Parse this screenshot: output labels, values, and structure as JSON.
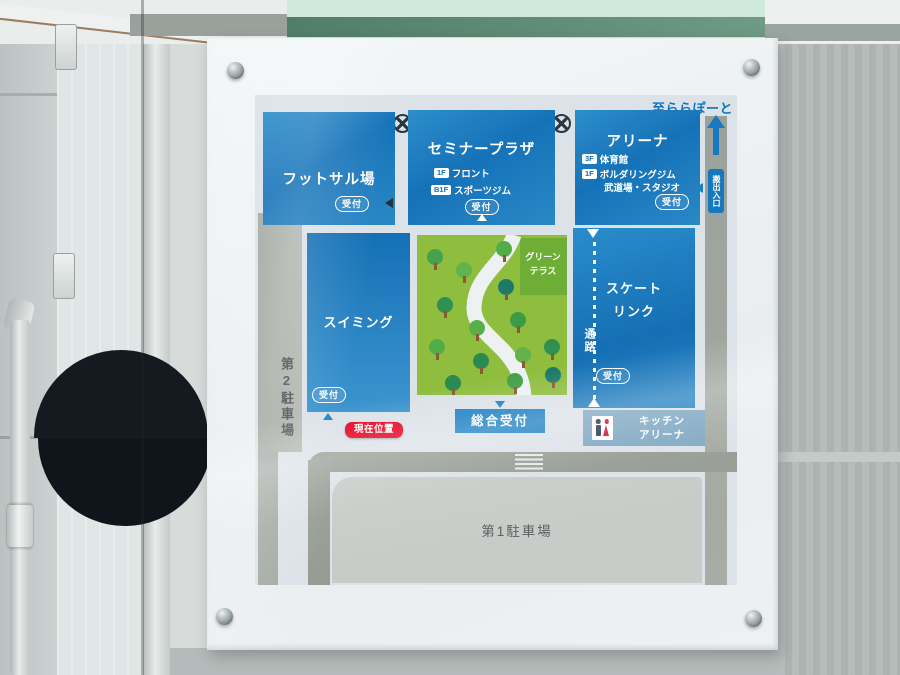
{
  "sign": {
    "map": {
      "direction_note": "至ららぽーと",
      "service_entrance_label": "搬出入口",
      "reception_label": "受付",
      "facilities": {
        "futsal": {
          "title": "フットサル場"
        },
        "seminar_plaza": {
          "title": "セミナープラザ",
          "floors": [
            {
              "floor": "1F",
              "name": "フロント"
            },
            {
              "floor": "B1F",
              "name": "スポーツジム"
            }
          ]
        },
        "arena": {
          "title": "アリーナ",
          "floors": [
            {
              "floor": "3F",
              "name": "体育館"
            },
            {
              "floor": "1F",
              "name": "ボルダリングジム"
            }
          ],
          "floors_extra": "武道場・スタジオ"
        },
        "swimming": {
          "title": "スイミング"
        },
        "skate_rink": {
          "title_line1": "スケート",
          "title_line2": "リンク"
        },
        "green_terrace": {
          "title_line1": "グリーン",
          "title_line2": "テラス"
        },
        "kitchen_arena": {
          "title_line1": "キッチン",
          "title_line2": "アリーナ"
        }
      },
      "labels": {
        "general_reception": "総合受付",
        "current_location": "現在位置",
        "parking_lot_1": "第1駐車場",
        "parking_lot_2": "第2駐車場",
        "passage": "通路"
      },
      "icons": {
        "no_entry": "circle-x-icon",
        "route_up": "up-arrow-icon",
        "entrance": "left-arrow-icon",
        "restroom": "restroom-icon",
        "crosswalk": "crosswalk-icon",
        "passage": "dotted-passage-line",
        "tree": "tree-icon",
        "screw": "screw-icon"
      },
      "colors": {
        "facility_blue": "#1b7fc4",
        "kitchen_bar_blue": "#7fa7c2",
        "map_background": "#dbe2e8",
        "road_gray": "#9aa19b",
        "parking_fill_gray": "#c7ccc8",
        "terrace_green": "#8fbe3f",
        "terrace_green_dark": "#6fae36",
        "current_location_red": "#e60020",
        "direction_text_blue": "#0b76c0"
      }
    }
  }
}
